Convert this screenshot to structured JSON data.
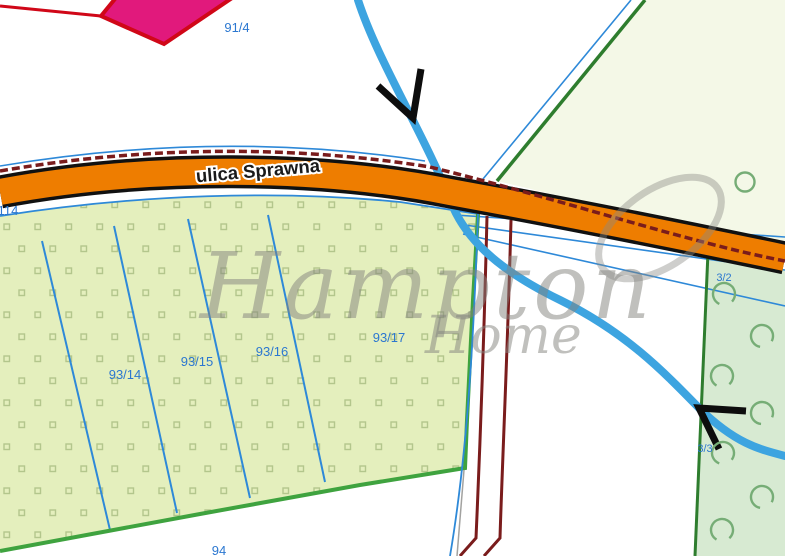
{
  "map": {
    "street_label": "ulica Sprawna",
    "watermark": {
      "line1": "Hampton",
      "line2": "Home"
    },
    "parcel_labels": {
      "p91_4": "91/4",
      "p114": "114",
      "p93_14": "93/14",
      "p93_15": "93/15",
      "p93_16": "93/16",
      "p93_17": "93/17",
      "p94": "94",
      "p3_2": "3/2",
      "p3_3": "3/3"
    },
    "colors": {
      "road_orange": "#ee7d00",
      "river_blue": "#3da4e0",
      "parcel_fill_green": "#e4efbd",
      "mint_fill_green": "#d7ead2",
      "pale_fill_green": "#f4f8e7",
      "boundary_maroon": "#7a1c1c",
      "line_blue": "#2e89d8",
      "label_blue": "#2b77d0",
      "border_green": "#3fa33f",
      "marker_pink": "#e1197c",
      "marker_red": "#d00718"
    }
  }
}
